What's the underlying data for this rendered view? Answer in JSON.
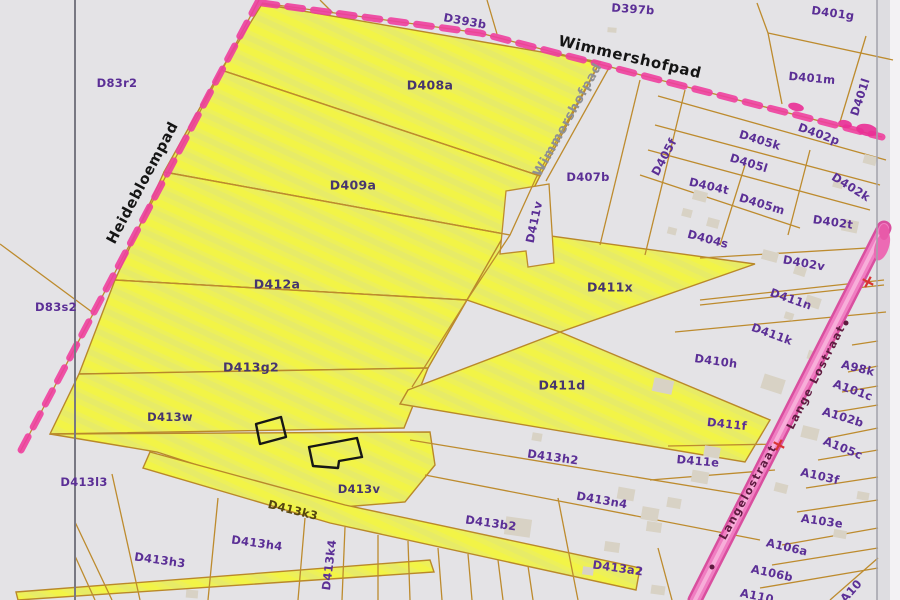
{
  "map": {
    "title": "Cadastral parcel map (scan)",
    "colors": {
      "background": "#e4e3e6",
      "highlight_yellow": "#edf059",
      "boundary_orange": "#bd8b2e",
      "dash_pink": "#ee3f9f",
      "road_pink": "#f07ec2",
      "label_purple": "#5b2f96",
      "street_black": "#151515",
      "road_text": "#5e1b40"
    },
    "parcels": [
      {
        "id": "D83r2",
        "x": 117,
        "y": 83,
        "rot": 0
      },
      {
        "id": "D393b",
        "x": 465,
        "y": 21,
        "rot": 10
      },
      {
        "id": "D397b",
        "x": 633,
        "y": 9,
        "rot": 4
      },
      {
        "id": "D401g",
        "x": 833,
        "y": 13,
        "rot": 8
      },
      {
        "id": "D401m",
        "x": 812,
        "y": 78,
        "rot": 5
      },
      {
        "id": "D401l",
        "x": 860,
        "y": 97,
        "rot": -72
      },
      {
        "id": "D402p",
        "x": 819,
        "y": 134,
        "rot": 20
      },
      {
        "id": "D405k",
        "x": 760,
        "y": 140,
        "rot": 17
      },
      {
        "id": "D405l",
        "x": 749,
        "y": 163,
        "rot": 17
      },
      {
        "id": "D405f",
        "x": 664,
        "y": 157,
        "rot": -62
      },
      {
        "id": "D404t",
        "x": 709,
        "y": 186,
        "rot": 13
      },
      {
        "id": "D405m",
        "x": 762,
        "y": 204,
        "rot": 17
      },
      {
        "id": "D402k",
        "x": 851,
        "y": 187,
        "rot": 32
      },
      {
        "id": "D402t",
        "x": 833,
        "y": 222,
        "rot": 8
      },
      {
        "id": "D404s",
        "x": 708,
        "y": 239,
        "rot": 15
      },
      {
        "id": "D407b",
        "x": 588,
        "y": 177,
        "rot": 0
      },
      {
        "id": "D411v",
        "x": 534,
        "y": 222,
        "rot": -78
      },
      {
        "id": "D408a",
        "x": 430,
        "y": 85,
        "rot": 0,
        "tone": "on-yellow",
        "size": 12.5
      },
      {
        "id": "D409a",
        "x": 353,
        "y": 185,
        "rot": 0,
        "tone": "on-yellow",
        "size": 12.5
      },
      {
        "id": "D412a",
        "x": 277,
        "y": 284,
        "rot": 0,
        "tone": "on-yellow",
        "size": 12.5
      },
      {
        "id": "D83s2",
        "x": 56,
        "y": 307,
        "rot": 0
      },
      {
        "id": "D411x",
        "x": 610,
        "y": 287,
        "rot": 0,
        "tone": "on-yellow",
        "size": 12.5
      },
      {
        "id": "D402v",
        "x": 804,
        "y": 263,
        "rot": 10
      },
      {
        "id": "D411n",
        "x": 791,
        "y": 299,
        "rot": 19
      },
      {
        "id": "D411k",
        "x": 772,
        "y": 334,
        "rot": 20
      },
      {
        "id": "D410h",
        "x": 716,
        "y": 361,
        "rot": 8
      },
      {
        "id": "A98k",
        "x": 858,
        "y": 368,
        "rot": 14
      },
      {
        "id": "A101c",
        "x": 853,
        "y": 390,
        "rot": 20
      },
      {
        "id": "A102b",
        "x": 843,
        "y": 417,
        "rot": 17
      },
      {
        "id": "A105c",
        "x": 843,
        "y": 448,
        "rot": 22
      },
      {
        "id": "A103f",
        "x": 820,
        "y": 476,
        "rot": 13
      },
      {
        "id": "A103e",
        "x": 822,
        "y": 521,
        "rot": 8
      },
      {
        "id": "A106a",
        "x": 787,
        "y": 547,
        "rot": 13
      },
      {
        "id": "A106b",
        "x": 772,
        "y": 573,
        "rot": 12
      },
      {
        "id": "A110",
        "x": 757,
        "y": 596,
        "rot": 12
      },
      {
        "id": "A10",
        "x": 851,
        "y": 591,
        "rot": -48
      },
      {
        "id": "D413g2",
        "x": 251,
        "y": 367,
        "rot": 0,
        "tone": "on-yellow",
        "size": 12.5
      },
      {
        "id": "D411d",
        "x": 562,
        "y": 385,
        "rot": 0,
        "tone": "on-yellow",
        "size": 12.5
      },
      {
        "id": "D413w",
        "x": 170,
        "y": 417,
        "rot": 0,
        "tone": "on-yellow"
      },
      {
        "id": "D413l3",
        "x": 84,
        "y": 482,
        "rot": 0
      },
      {
        "id": "D413v",
        "x": 359,
        "y": 489,
        "rot": 0,
        "tone": "on-yellow"
      },
      {
        "id": "D413k3",
        "x": 293,
        "y": 510,
        "rot": 14,
        "tone": "olive"
      },
      {
        "id": "D413h2",
        "x": 553,
        "y": 457,
        "rot": 8
      },
      {
        "id": "D411f",
        "x": 727,
        "y": 424,
        "rot": 6
      },
      {
        "id": "D411e",
        "x": 698,
        "y": 461,
        "rot": 5
      },
      {
        "id": "D413n4",
        "x": 602,
        "y": 500,
        "rot": 10
      },
      {
        "id": "D413b2",
        "x": 491,
        "y": 523,
        "rot": 8
      },
      {
        "id": "D413h3",
        "x": 160,
        "y": 560,
        "rot": 8
      },
      {
        "id": "D413h4",
        "x": 257,
        "y": 543,
        "rot": 8
      },
      {
        "id": "D413k4",
        "x": 329,
        "y": 565,
        "rot": -83
      },
      {
        "id": "D413a2",
        "x": 618,
        "y": 568,
        "rot": 8
      }
    ],
    "streets": [
      {
        "name": "Wimmershofpad",
        "x": 630,
        "y": 57,
        "rot": 13,
        "color": "#151515",
        "size": 15,
        "kind": "path"
      },
      {
        "name": "Wimmershofpad",
        "x": 568,
        "y": 120,
        "rot": -61,
        "color": "#8f9093",
        "size": 13,
        "kind": "path"
      },
      {
        "name": "Heidebloempad",
        "x": 143,
        "y": 183,
        "rot": -62,
        "color": "#151515",
        "size": 14.5,
        "kind": "path"
      },
      {
        "name": "Lange Lostraat",
        "x": 816,
        "y": 377,
        "rot": -63,
        "color": "#5e1b40",
        "size": 11,
        "kind": "road"
      },
      {
        "name": "Langelostraat",
        "x": 748,
        "y": 492,
        "rot": -61,
        "color": "#5e1b40",
        "size": 11,
        "kind": "road"
      }
    ],
    "markers": {
      "crosses": [
        {
          "x": 868,
          "y": 282,
          "rot": 28
        },
        {
          "x": 779,
          "y": 445,
          "rot": 28
        }
      ],
      "dots": [
        {
          "x": 846,
          "y": 323
        },
        {
          "x": 712,
          "y": 567
        }
      ]
    },
    "buildings": [
      [
        700,
        196,
        14,
        10,
        15
      ],
      [
        687,
        213,
        10,
        8,
        15
      ],
      [
        713,
        223,
        12,
        9,
        15
      ],
      [
        672,
        231,
        9,
        7,
        15
      ],
      [
        770,
        256,
        16,
        10,
        15
      ],
      [
        870,
        160,
        13,
        9,
        15
      ],
      [
        838,
        184,
        10,
        8,
        15
      ],
      [
        850,
        226,
        16,
        12,
        12
      ],
      [
        800,
        271,
        12,
        9,
        18
      ],
      [
        813,
        302,
        15,
        11,
        18
      ],
      [
        830,
        334,
        12,
        9,
        18
      ],
      [
        789,
        316,
        9,
        7,
        18
      ],
      [
        814,
        356,
        13,
        9,
        18
      ],
      [
        773,
        384,
        22,
        15,
        18
      ],
      [
        663,
        386,
        20,
        14,
        12
      ],
      [
        712,
        452,
        16,
        11,
        10
      ],
      [
        700,
        477,
        17,
        12,
        10
      ],
      [
        674,
        503,
        14,
        10,
        10
      ],
      [
        810,
        433,
        17,
        12,
        14
      ],
      [
        781,
        488,
        13,
        9,
        14
      ],
      [
        863,
        496,
        12,
        8,
        10
      ],
      [
        840,
        534,
        13,
        8,
        10
      ],
      [
        537,
        437,
        10,
        8,
        10
      ],
      [
        518,
        527,
        26,
        18,
        8
      ],
      [
        626,
        494,
        17,
        12,
        10
      ],
      [
        650,
        514,
        17,
        13,
        10
      ],
      [
        654,
        527,
        15,
        10,
        8
      ],
      [
        612,
        547,
        15,
        10,
        8
      ],
      [
        588,
        571,
        11,
        8,
        8
      ],
      [
        658,
        590,
        14,
        9,
        8
      ],
      [
        612,
        30,
        9,
        5,
        5
      ],
      [
        192,
        594,
        12,
        8,
        5
      ]
    ],
    "sketch_shapes": [
      "256,424 281,417 286,437 260,444",
      "309,447 357,438 362,457 339,461 338,468 313,466"
    ]
  }
}
